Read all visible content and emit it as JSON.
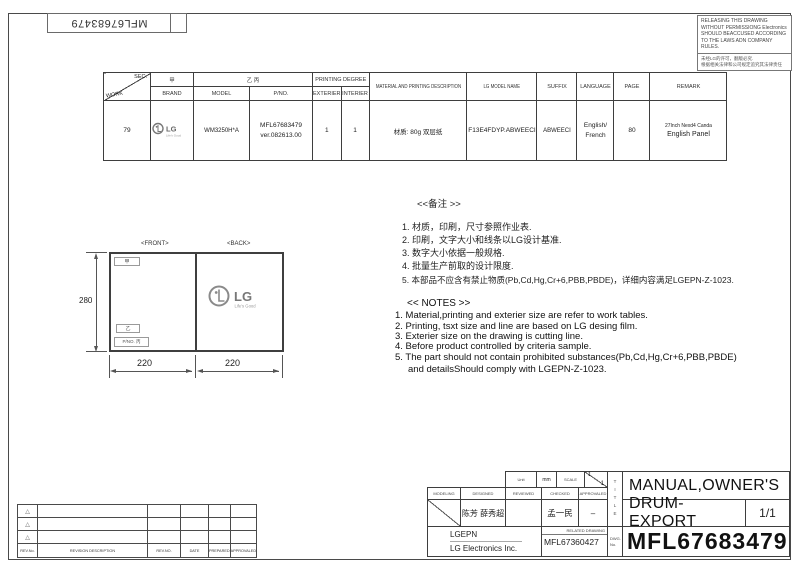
{
  "sheet": {
    "stamp_number": "MFL67683479",
    "notice_en": "RELEASING THIS DRAWING WITHOUT PERMISSIONG Electronics SHOULD BEACCUSED ACCORDING TO THE LAWS ADN COMPANY RULES.",
    "notice_zh_line1": "未经LG的许可，翻版必究.",
    "notice_zh_line2": "根据相关法律和公司规定追究其法律责任"
  },
  "spec_table": {
    "headers": {
      "sec": "SEC.",
      "work": "WORK",
      "brand_cn": "甲",
      "brand": "BRAND",
      "model_cn": "乙 丙",
      "model": "MODEL",
      "pno": "P/NO.",
      "printing_degree": "PRINTING DEGREE",
      "exterier": "EXTERIER",
      "interier": "INTERIER",
      "material": "MATERIAL AND PRINTING DESCRIPTION",
      "lg_model_name": "LG MODEL NAME",
      "suffix": "SUFFIX",
      "language": "LANGUAGE",
      "page": "PAGE",
      "remark": "REMARK"
    },
    "row": {
      "work": "79",
      "brand_logo_text": "LG",
      "brand_logo_tagline": "Life's Good",
      "model": "WM3250H*A",
      "pno_line1": "MFL67683479",
      "pno_line2": "ver.082613.00",
      "exterier": "1",
      "interier": "1",
      "material": "材质: 80g 双层纸",
      "lg_model_name": "F13E4FDYP.ABWEECI",
      "suffix": "ABWEECI",
      "language_line1": "English/",
      "language_line2": "French",
      "page": "80",
      "remark_line1": "27Inch Nexd4 Canda",
      "remark_line2": "English  Panel"
    }
  },
  "drawing": {
    "front_label": "<FRONT>",
    "back_label": "<BACK>",
    "box_jia": "甲",
    "box_yi": "乙",
    "box_pno": "P/NO. 丙",
    "dim_height": "280",
    "dim_width_front": "220",
    "dim_width_back": "220",
    "logo_text": "LG",
    "logo_tagline": "Life's Good"
  },
  "notes_zh": {
    "header": "<<备注 >>",
    "items": [
      "1.  材质，印刷，尺寸参照作业表.",
      "2.  印刷，文字大小和线条以LG设计基准.",
      "3.  数字大小依据一般规格.",
      "4.  批量生产前取的设计限度.",
      "5.  本部品不应含有禁止物质(Pb,Cd,Hg,Cr+6,PBB,PBDE)，详细内容满足LGEPN-Z-1023."
    ]
  },
  "notes_en": {
    "header": "<< NOTES >>",
    "items": [
      "1. Material,printing and exterier size are refer to work tables.",
      "2. Printing, tsxt  size and line are based on LG desing film.",
      "3. Exterier size on the drawing is cutting line.",
      "4. Before product controlled by criteria sample.",
      "5. The part should not contain prohibited substances(Pb,Cd,Hg,Cr+6,PBB,PBDE)",
      "and detailsShould comply with LGEPN-Z-1023."
    ]
  },
  "title_block": {
    "unit_label": "Unit",
    "unit_value": "mm",
    "scale_label": "SCALE",
    "scale_numerator": "1",
    "scale_denominator": "1",
    "modeling_label": "MODELING",
    "designed_label": "DESIGNED",
    "reviewed_label": "REVIEWED",
    "checked_label": "CHECKED",
    "approvaled_label": "APPROVALED",
    "designed_names": "陈芳 薛秀超",
    "checked_name": "孟一民",
    "approvaled_value": "–",
    "company_code": "LGEPN",
    "company_name": "LG Electronics Inc.",
    "related_drawing_label": "RELATED DRAWING",
    "related_drawing_no": "MFL67360427",
    "title_vertical_label": "TITLE",
    "dwg_label_line1": "DWG.",
    "dwg_label_line2": "No.",
    "title_line1": "MANUAL,OWNER'S",
    "title_line2": "DRUM-EXPORT",
    "sheet_no": "1/1",
    "part_no": "MFL67683479"
  },
  "revision_table": {
    "marker": "△",
    "rev_no_label": "REV.No.",
    "description_label": "REVISION DESCRIPTION",
    "rev_no2_label": "REV.NO.",
    "date_label": "DATE",
    "prepared_label": "PREPARED",
    "approvaled_label": "APPROVALED"
  }
}
